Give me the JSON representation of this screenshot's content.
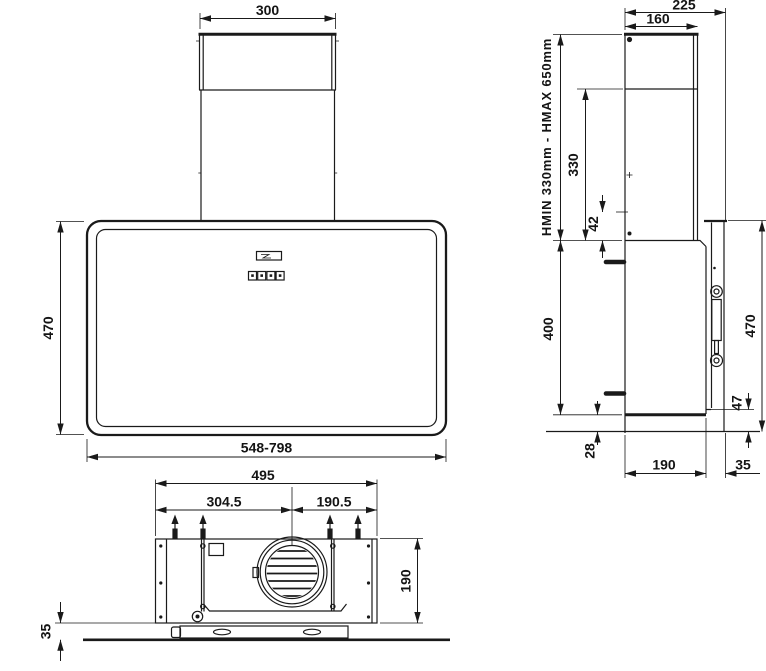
{
  "drawing": {
    "front_view": {
      "chimney_width": "300",
      "body_height": "470",
      "body_width_range": "548-798"
    },
    "side_view": {
      "total_depth": "225",
      "chimney_depth": "160",
      "height_range": "HMIN 330mm - HMAX 650mm",
      "chimney_lower_height": "330",
      "outlet_offset": "42",
      "body_height": "400",
      "body_bottom_offset": "28",
      "glass_height": "470",
      "front_notch": "47",
      "body_depth": "190",
      "glass_offset": "35"
    },
    "bottom_view": {
      "mount_width": "495",
      "left_span": "304.5",
      "right_span": "190.5",
      "body_depth": "190",
      "glass_offset": "35"
    }
  }
}
